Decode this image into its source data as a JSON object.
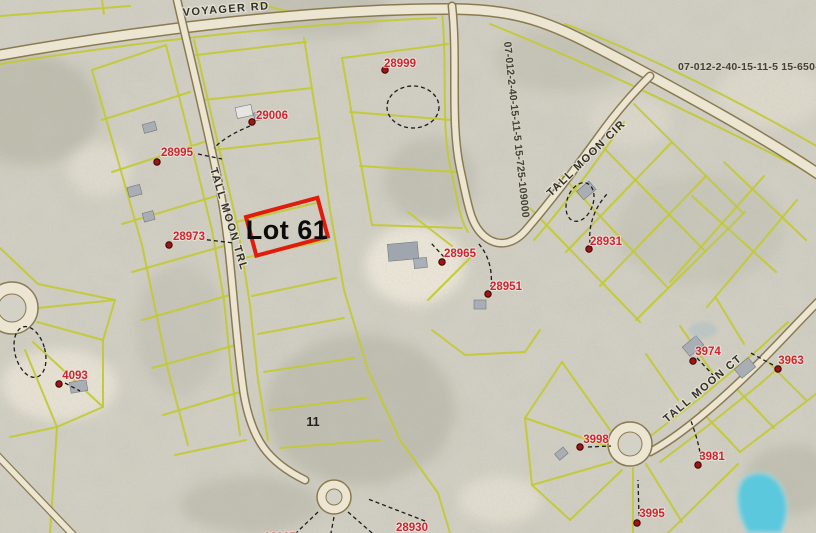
{
  "map": {
    "highlight_label": "Lot 61",
    "section_number": "11",
    "streets": {
      "voyager": "VOYAGER RD",
      "tall_moon_trl": "TALL MOON TRL",
      "tall_moon_cir": "TALL MOON CIR",
      "tall_moon_ct": "TALL MOON CT"
    },
    "parcel_ids": {
      "rotated": "07-012-2-40-15-11-5 15-725-109000",
      "truncated": "07-012-2-40-15-11-5 15-650-"
    },
    "lots": {
      "l28999": "28999",
      "l29006": "29006",
      "l28995": "28995",
      "l28973": "28973",
      "l28965": "28965",
      "l28951": "28951",
      "l28931": "28931",
      "l4093": "4093",
      "l3974": "3974",
      "l3963": "3963",
      "l3998": "3998",
      "l3981": "3981",
      "l3995": "3995",
      "l28930": "28930",
      "l28937": "28937"
    },
    "colors": {
      "parcel_line_yellow": "#c2c937",
      "highlight_red": "#e01c0c",
      "lot_number_red": "#cf2533",
      "road_fill": "#ebe5d2",
      "road_edge": "#8a7a50",
      "pond_blue": "#5cc8de",
      "background": "#d6d2c7"
    }
  }
}
